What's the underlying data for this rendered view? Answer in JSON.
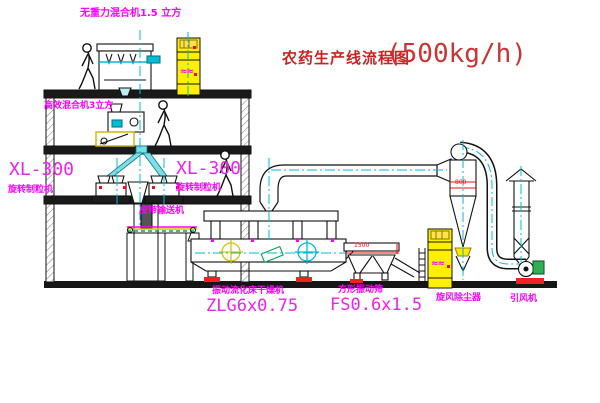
{
  "title": {
    "cn": "农药生产线流程图",
    "capacity": "(500kg/h)"
  },
  "labels": {
    "mixer_top": "无重力混合机1.5 立方",
    "mixer_floor2": "高效混合机3立方",
    "granulator_model_left": "XL-300",
    "granulator_name_left": "旋转制粒机",
    "granulator_model_right": "XL-300",
    "granulator_name_right": "旋转制粒机",
    "belt_conveyor": "皮带输送机",
    "dryer_name": "振动流化床干燥机",
    "dryer_model": "ZLG6x0.75",
    "sieve_name": "方形振动筛",
    "sieve_model": "FS0.6x1.5",
    "cyclone": "旋风除尘器",
    "fan": "引风机"
  },
  "dimensions": {
    "sieve": "1500",
    "cyclone": "800"
  },
  "marks": {
    "elevator": "≈≈"
  },
  "colors": {
    "label_magenta": "#ff00ff",
    "title_red": "#cc2222",
    "equipment_yellow": "#ffef00",
    "centerline_cyan": "#00bcd4",
    "accent_green": "#00a651",
    "line_black": "#111111"
  }
}
